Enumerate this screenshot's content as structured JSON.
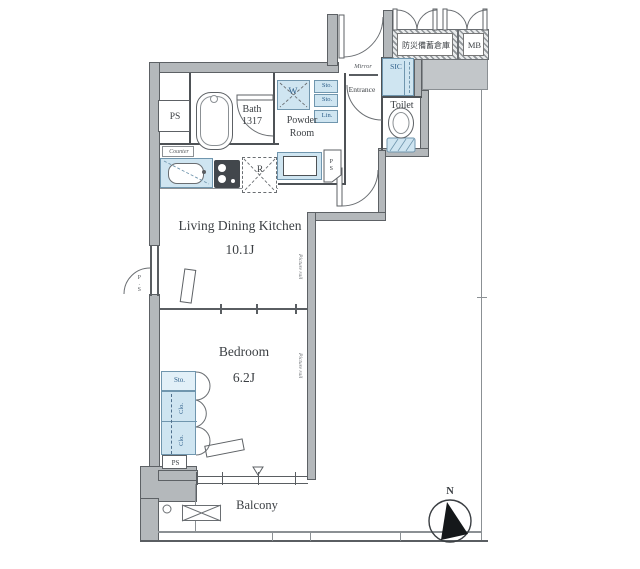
{
  "labels": {
    "storage": "防災備蓄倉庫",
    "mb": "MB",
    "entrance": "Entrance",
    "mirror": "Mirror",
    "sic": "SIC",
    "toilet": "Toilet",
    "powder_line1": "Powder",
    "powder_line2": "Room",
    "washer": "W",
    "sto_a": "Sto.",
    "sto_b": "Sto.",
    "lin": "Lin.",
    "ps_pentagon": "PS",
    "bath_line1": "Bath",
    "bath_line2": "1317",
    "ps_top": "PS",
    "counter": "Counter",
    "fridge": "R",
    "ldk_name": "Living Dining Kitchen",
    "ldk_size": "10.1J",
    "picture_rail_ldk": "Picture rail",
    "picture_rail_bedroom": "Picture rail",
    "left_shaft": "P.S",
    "bedroom_name": "Bedroom",
    "bedroom_size": "6.2J",
    "closet_sto": "Sto.",
    "closet_clo1": "Clo.",
    "closet_clo2": "Clo.",
    "ps_bottom": "PS",
    "balcony": "Balcony",
    "compass_n": "N"
  },
  "icons": {
    "window_marker": "triangle-down-icon",
    "compass": "north-arrow-icon"
  },
  "colors": {
    "wall": "#b4b8bb",
    "wall_edge": "#5d6165",
    "fixture_blue": "#cfe5f1",
    "fixture_blue_border": "#7096ae",
    "blue_text": "#2e5f8a",
    "line": "#5a5e62",
    "text": "#3b3f43"
  }
}
